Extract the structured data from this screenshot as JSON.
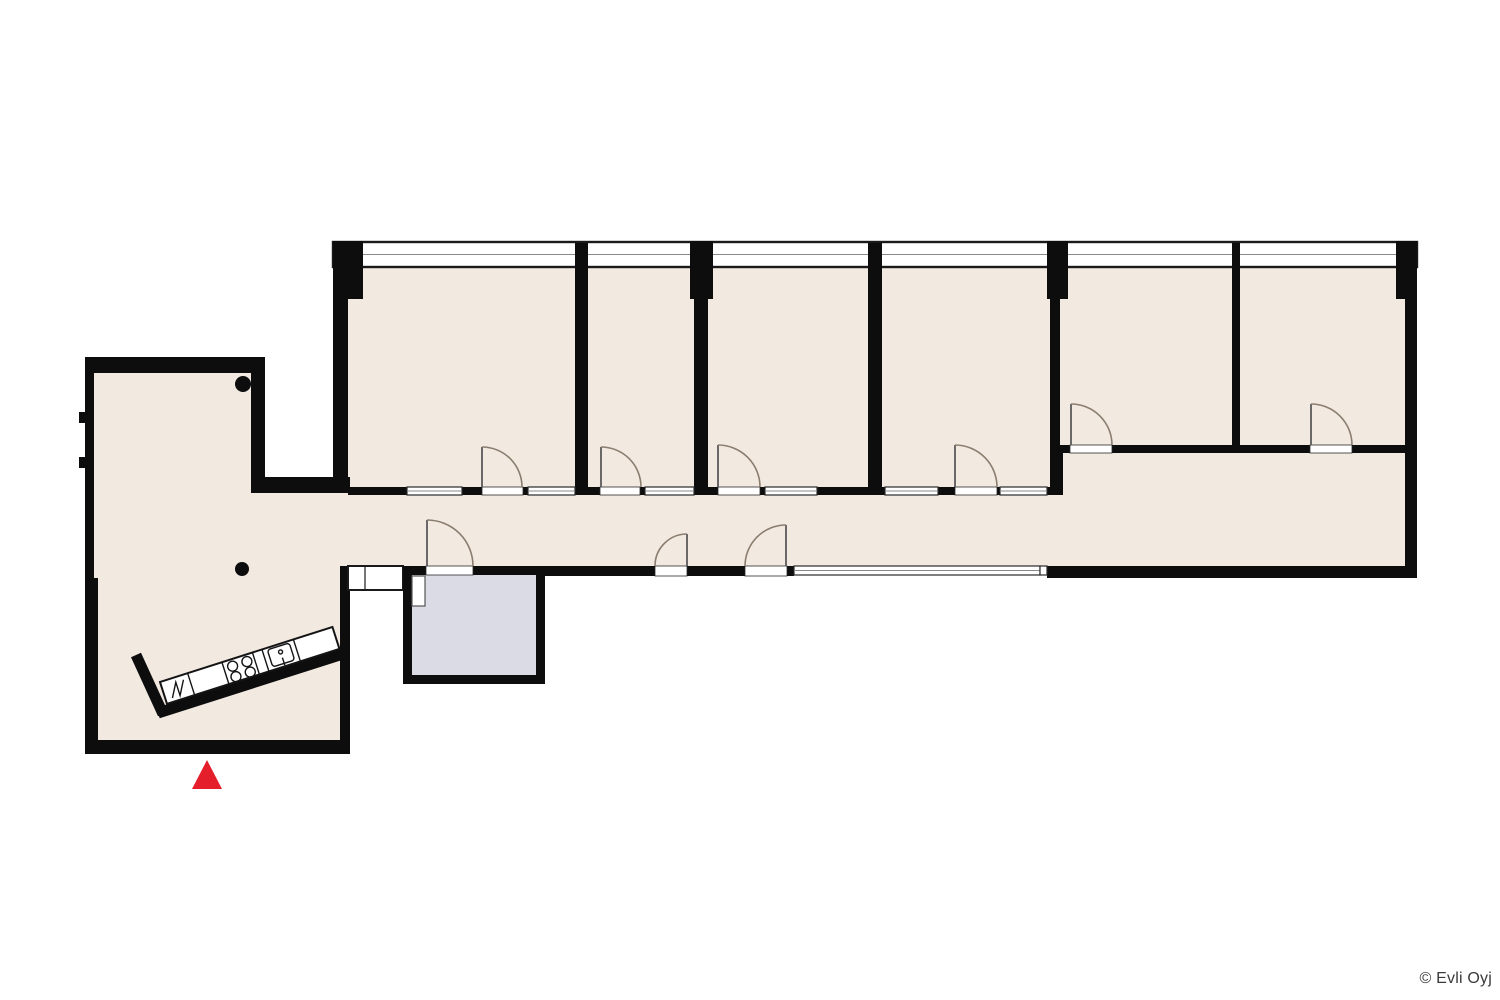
{
  "footer": {
    "copyright": "© Evli Oyj"
  },
  "colors": {
    "floor-beige": "#f2e9e1",
    "highlight-room-gray": "#dadbe5",
    "wall-black": "#0d0d0d",
    "door-arc": "#8b7d6e",
    "entrance-red": "#e41e2b",
    "window-white": "#ffffff",
    "window-frame": "#2a2a2a",
    "copyright-text": "#3a3a3a"
  },
  "plan": {
    "type": "architectural floor plan",
    "office_rooms_top_row": 6,
    "highlighted_rooms": 1,
    "corridor": "connects lobby to all rooms",
    "lobby_features": [
      "diagonal kitchen counter",
      "four burner stove",
      "sink",
      "refrigerator mark",
      "two structural columns"
    ],
    "entrance_marker": {
      "shape": "triangle",
      "pointing": "up",
      "color": "#e41e2b"
    }
  }
}
